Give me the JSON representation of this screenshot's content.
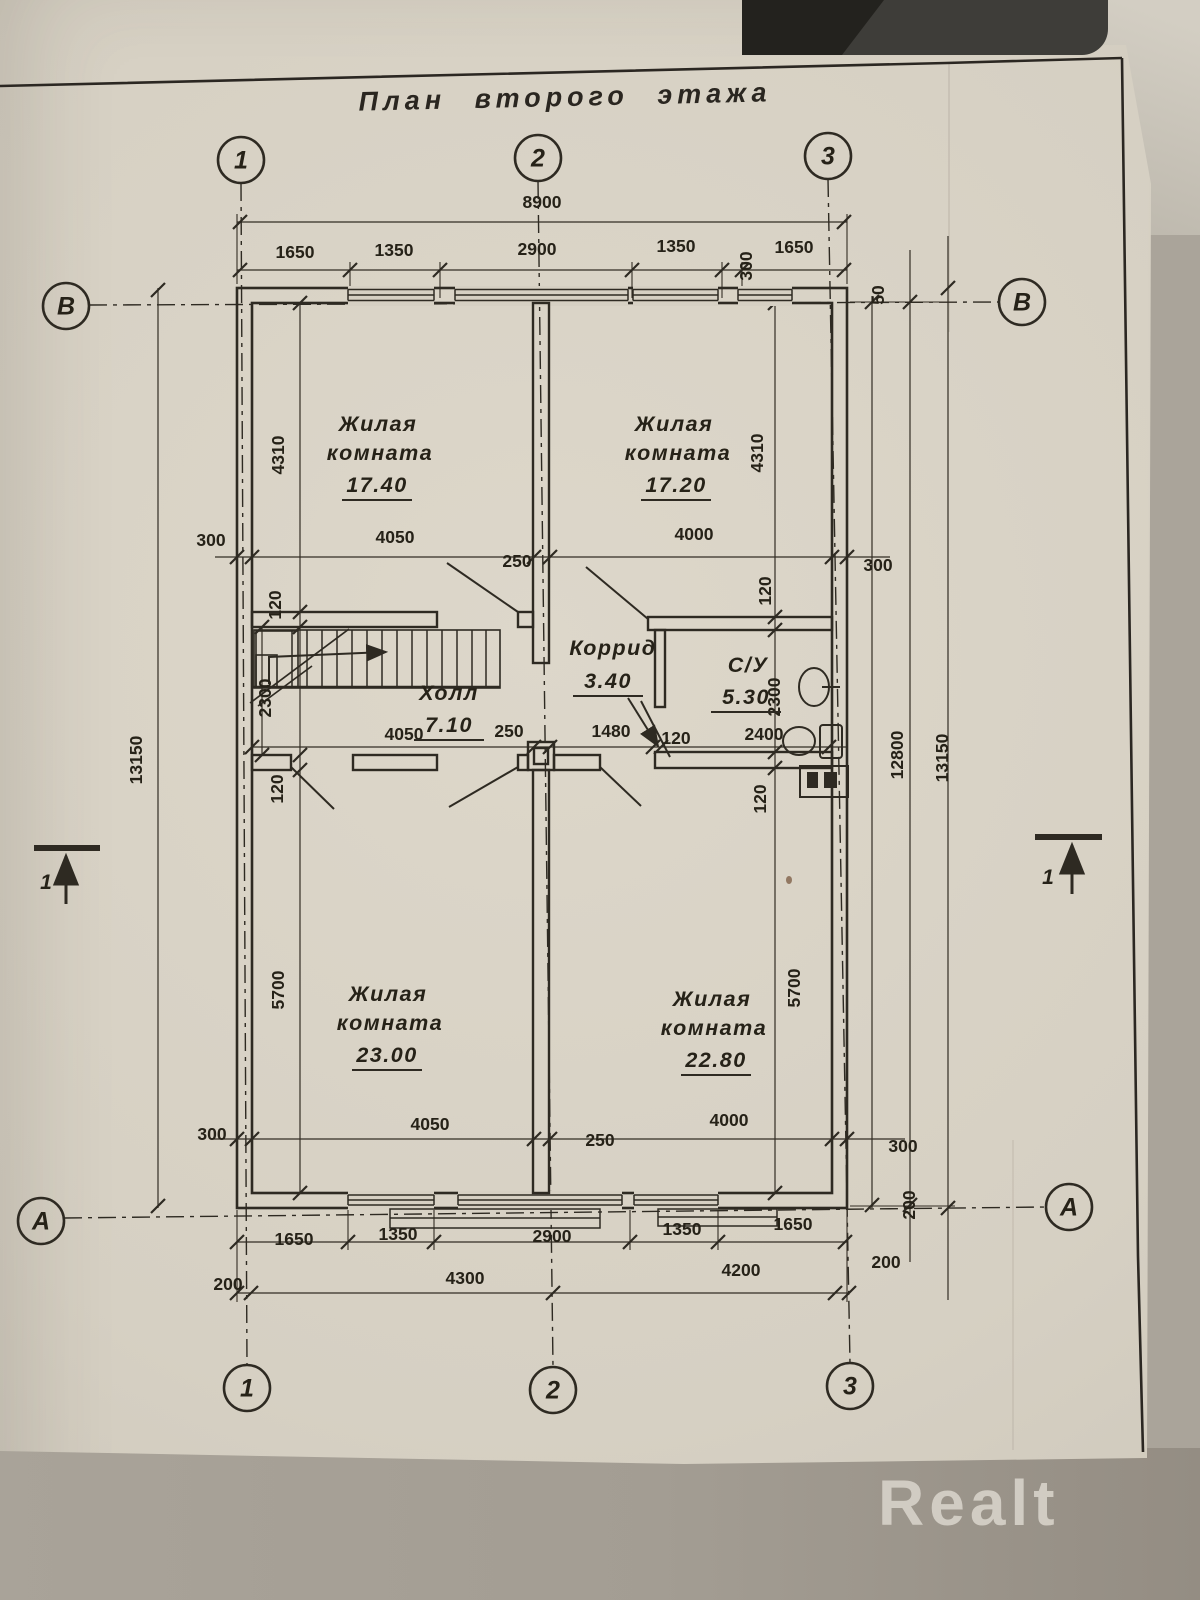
{
  "title": "План второго этажа",
  "watermark": "Realt",
  "colors": {
    "paper": "#d6d0c3",
    "ink": "#2e2a22",
    "watermark_color": "#d6d1c8",
    "table": "#a39d93"
  },
  "rooms": [
    {
      "name": "Жилая комната",
      "area": "17.40"
    },
    {
      "name": "Жилая комната",
      "area": "17.20"
    },
    {
      "name": "Холл",
      "area": "7.10"
    },
    {
      "name": "Коррид",
      "area": "3.40"
    },
    {
      "name": "С/У",
      "area": "5.30"
    },
    {
      "name": "Жилая комната",
      "area": "23.00"
    },
    {
      "name": "Жилая комната",
      "area": "22.80"
    }
  ],
  "axis_markers": [
    {
      "label": "1",
      "x": 241,
      "y": 160
    },
    {
      "label": "2",
      "x": 538,
      "y": 158
    },
    {
      "label": "3",
      "x": 828,
      "y": 156
    },
    {
      "label": "1",
      "x": 247,
      "y": 1388
    },
    {
      "label": "2",
      "x": 553,
      "y": 1390
    },
    {
      "label": "3",
      "x": 850,
      "y": 1386
    },
    {
      "label": "В",
      "x": 66,
      "y": 306
    },
    {
      "label": "В",
      "x": 1022,
      "y": 302
    },
    {
      "label": "А",
      "x": 41,
      "y": 1221
    },
    {
      "label": "А",
      "x": 1069,
      "y": 1207
    }
  ],
  "labels": [
    {
      "t": "8900",
      "x": 542,
      "y": 208,
      "k": "d"
    },
    {
      "t": "1650",
      "x": 295,
      "y": 258,
      "k": "d"
    },
    {
      "t": "1350",
      "x": 394,
      "y": 256,
      "k": "d"
    },
    {
      "t": "2900",
      "x": 537,
      "y": 255,
      "k": "d"
    },
    {
      "t": "1350",
      "x": 676,
      "y": 252,
      "k": "d"
    },
    {
      "t": "300",
      "x": 752,
      "y": 266,
      "k": "d",
      "r": 1
    },
    {
      "t": "1650",
      "x": 794,
      "y": 253,
      "k": "d"
    },
    {
      "t": "300",
      "x": 211,
      "y": 546,
      "k": "d"
    },
    {
      "t": "4050",
      "x": 395,
      "y": 543,
      "k": "d"
    },
    {
      "t": "250",
      "x": 517,
      "y": 567,
      "k": "d"
    },
    {
      "t": "4000",
      "x": 694,
      "y": 540,
      "k": "d"
    },
    {
      "t": "300",
      "x": 878,
      "y": 571,
      "k": "d"
    },
    {
      "t": "4050",
      "x": 404,
      "y": 740,
      "k": "d"
    },
    {
      "t": "250",
      "x": 509,
      "y": 737,
      "k": "d"
    },
    {
      "t": "1480",
      "x": 611,
      "y": 737,
      "k": "d"
    },
    {
      "t": "120",
      "x": 676,
      "y": 744,
      "k": "d"
    },
    {
      "t": "2400",
      "x": 764,
      "y": 740,
      "k": "d"
    },
    {
      "t": "300",
      "x": 212,
      "y": 1140,
      "k": "d"
    },
    {
      "t": "4050",
      "x": 430,
      "y": 1130,
      "k": "d"
    },
    {
      "t": "250",
      "x": 600,
      "y": 1146,
      "k": "d"
    },
    {
      "t": "4000",
      "x": 729,
      "y": 1126,
      "k": "d"
    },
    {
      "t": "300",
      "x": 903,
      "y": 1152,
      "k": "d"
    },
    {
      "t": "1650",
      "x": 294,
      "y": 1245,
      "k": "d"
    },
    {
      "t": "1350",
      "x": 398,
      "y": 1240,
      "k": "d"
    },
    {
      "t": "2900",
      "x": 552,
      "y": 1242,
      "k": "d"
    },
    {
      "t": "1350",
      "x": 682,
      "y": 1235,
      "k": "d"
    },
    {
      "t": "1650",
      "x": 793,
      "y": 1230,
      "k": "d"
    },
    {
      "t": "200",
      "x": 228,
      "y": 1290,
      "k": "d"
    },
    {
      "t": "4300",
      "x": 465,
      "y": 1284,
      "k": "d"
    },
    {
      "t": "4200",
      "x": 741,
      "y": 1276,
      "k": "d"
    },
    {
      "t": "200",
      "x": 886,
      "y": 1268,
      "k": "d"
    },
    {
      "t": "4310",
      "x": 284,
      "y": 455,
      "k": "d",
      "r": 1
    },
    {
      "t": "120",
      "x": 281,
      "y": 605,
      "k": "d",
      "r": 1
    },
    {
      "t": "2300",
      "x": 271,
      "y": 698,
      "k": "d",
      "r": 1
    },
    {
      "t": "120",
      "x": 283,
      "y": 789,
      "k": "d",
      "r": 1
    },
    {
      "t": "5700",
      "x": 284,
      "y": 990,
      "k": "d",
      "r": 1
    },
    {
      "t": "13150",
      "x": 142,
      "y": 760,
      "k": "d",
      "r": 1
    },
    {
      "t": "4310",
      "x": 763,
      "y": 453,
      "k": "d",
      "r": 1
    },
    {
      "t": "120",
      "x": 771,
      "y": 591,
      "k": "d",
      "r": 1
    },
    {
      "t": "2300",
      "x": 780,
      "y": 697,
      "k": "d",
      "r": 1
    },
    {
      "t": "120",
      "x": 766,
      "y": 799,
      "k": "d",
      "r": 1
    },
    {
      "t": "5700",
      "x": 800,
      "y": 988,
      "k": "d",
      "r": 1
    },
    {
      "t": "12800",
      "x": 903,
      "y": 755,
      "k": "d",
      "r": 1
    },
    {
      "t": "13150",
      "x": 948,
      "y": 758,
      "k": "d",
      "r": 1
    },
    {
      "t": "50",
      "x": 884,
      "y": 295,
      "k": "d",
      "r": 1
    },
    {
      "t": "200",
      "x": 915,
      "y": 1205,
      "k": "d",
      "r": 1
    },
    {
      "t": "Жилая",
      "x": 378,
      "y": 431,
      "k": "room"
    },
    {
      "t": "комната",
      "x": 380,
      "y": 460,
      "k": "room"
    },
    {
      "t": "17.40",
      "x": 377,
      "y": 492,
      "k": "area"
    },
    {
      "t": "Жилая",
      "x": 674,
      "y": 431,
      "k": "room"
    },
    {
      "t": "комната",
      "x": 678,
      "y": 460,
      "k": "room"
    },
    {
      "t": "17.20",
      "x": 676,
      "y": 492,
      "k": "area"
    },
    {
      "t": "Холл",
      "x": 449,
      "y": 700,
      "k": "room"
    },
    {
      "t": "7.10",
      "x": 449,
      "y": 732,
      "k": "area"
    },
    {
      "t": "Коррид",
      "x": 613,
      "y": 655,
      "k": "room"
    },
    {
      "t": "3.40",
      "x": 608,
      "y": 688,
      "k": "area"
    },
    {
      "t": "С/У",
      "x": 748,
      "y": 672,
      "k": "room"
    },
    {
      "t": "5.30",
      "x": 746,
      "y": 704,
      "k": "area"
    },
    {
      "t": "Жилая",
      "x": 388,
      "y": 1001,
      "k": "room"
    },
    {
      "t": "комната",
      "x": 390,
      "y": 1030,
      "k": "room"
    },
    {
      "t": "23.00",
      "x": 387,
      "y": 1062,
      "k": "area"
    },
    {
      "t": "Жилая",
      "x": 712,
      "y": 1006,
      "k": "room"
    },
    {
      "t": "комната",
      "x": 714,
      "y": 1035,
      "k": "room"
    },
    {
      "t": "22.80",
      "x": 716,
      "y": 1067,
      "k": "area"
    },
    {
      "t": "1",
      "x": 46,
      "y": 889,
      "k": "sec"
    },
    {
      "t": "1",
      "x": 1048,
      "y": 884,
      "k": "sec"
    }
  ]
}
